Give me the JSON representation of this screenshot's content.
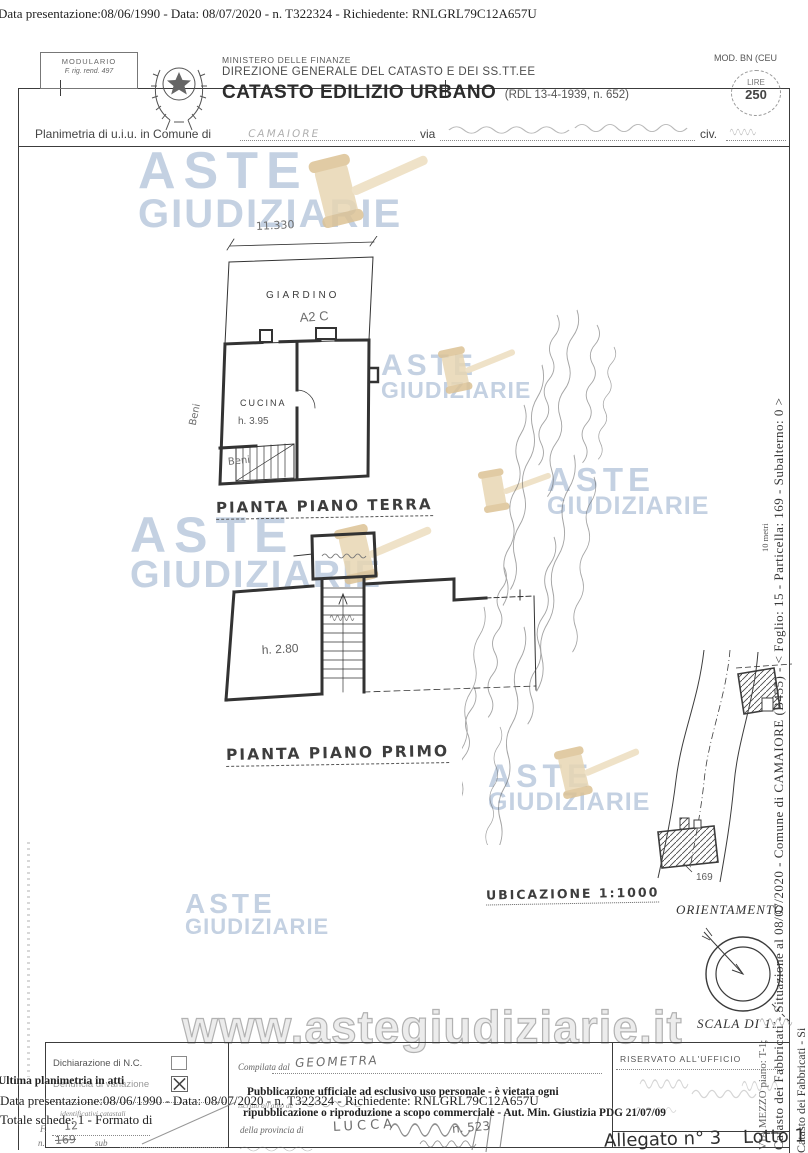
{
  "page": {
    "top_line": "Data presentazione:08/06/1990 - Data: 08/07/2020 - n. T322324 - Richiedente: RNLGRL79C12A657U"
  },
  "header": {
    "modulario_title": "MODULARIO",
    "modulario_sub": "F. rig. rend. 497",
    "ministry": "MINISTERO DELLE FINANZE",
    "directorate": "DIREZIONE GENERALE DEL CATASTO E DEI SS.TT.EE",
    "title": "CATASTO EDILIZIO URBANO",
    "title_ref": "(RDL 13-4-1939, n. 652)",
    "mod_code": "MOD. BN (CEU",
    "stamp": {
      "currency": "LIRE",
      "value": "250"
    }
  },
  "location_line": {
    "prefix": "Planimetria di u.i.u. in Comune di",
    "comune": "CAMAIORE",
    "via_label": "via",
    "civ_label": "civ."
  },
  "drawing": {
    "dim_note": "11.330",
    "terra": {
      "garden": "GIARDINO",
      "garden_note": "A2 C",
      "kitchen": "CUCINA",
      "kitchen_h": "h. 3.95",
      "beni_side": "Beni",
      "beni_bottom": "Beni",
      "caption": "PIANTA PIANO TERRA"
    },
    "primo": {
      "height": "h. 2.80",
      "caption": "PIANTA PIANO PRIMO"
    },
    "map": {
      "parcel": "169",
      "caption": "UBICAZIONE 1:1000"
    },
    "orientation": "ORIENTAMENTO",
    "scale": "SCALA DI 1:"
  },
  "watermark": {
    "line1": "ASTE",
    "line2": "GIUDIZIARIE",
    "url": "www.astegiudiziarie.it",
    "blue": "#aec3da",
    "tan": "#e9d9ba"
  },
  "margin_text": {
    "right_main": "Catasto dei Fabbricati - Situazione al 08/07/2020 - Comune di CAMAIORE (B455) - < Foglio: 15 - Particella: 169 - Subalterno: 0 >",
    "right_secondary": "VIA MEZZO piano: T-1;",
    "right_scale_note": "10 metri"
  },
  "footer": {
    "dichiarazione": "Dichiarazione di N.C.",
    "variazione": "Denuncia di variazione",
    "overlay_planimetria": "Ultima planimetria in atti",
    "identificativi": "identificativi catastali",
    "f_label": "F.",
    "f_value": "12",
    "n_label": "n.",
    "n_value": "169",
    "sub_label": "sub",
    "compilata": "Compilata dal",
    "compilata_value": "GEOMETRA",
    "iscritto": "iscritto all'albo de",
    "provincia": "della provincia di",
    "provincia_value": "LUCCA",
    "albo_n": "n. 523",
    "riservato": "RISERVATO ALL'UFFICIO",
    "overlay_data": "Data presentazione:08/06/1990 - Data: 08/07/2020 - n. T322324 - Richiedente: RNLGRL79C12A657U",
    "overlay_totale": "Totale schede: 1 - Formato di",
    "overlay_pub1": "Pubblicazione ufficiale ad esclusivo uso personale - è vietata ogni",
    "overlay_pub2": "ripubblicazione o riproduzione a scopo commerciale - Aut. Min. Giustizia PDG 21/07/09",
    "allegato": "Allegato n° 3",
    "lotto": "Lotto 1"
  }
}
